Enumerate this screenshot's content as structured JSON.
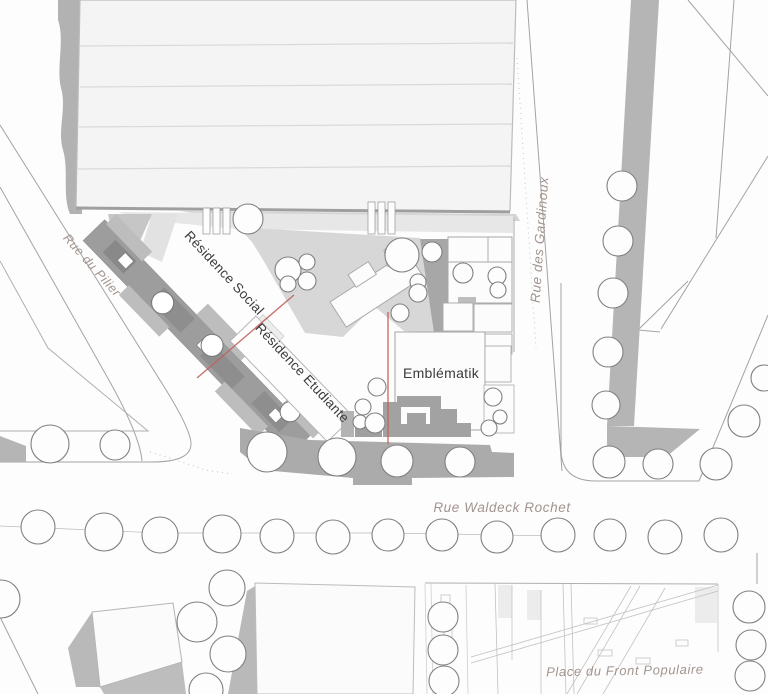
{
  "plan": {
    "streets": {
      "rue_du_pilier": "Rue du Pilier",
      "rue_des_gardinoux": "Rue des Gardinoux",
      "rue_waldeck_rochet": "Rue Waldeck Rochet",
      "place_du_front_populaire": "Place du Front Populaire"
    },
    "buildings": {
      "residence_social": "Résidence Social",
      "residence_etudiante": "Résidence Etudiante",
      "emblematik": "Emblématik"
    }
  },
  "colors": {
    "street_label": "#a2948e",
    "building_label": "#3b3b3b",
    "site_boundary_line": "#c0635c",
    "tree_outline": "#808080",
    "courtyard_gray": "#d7d7d7",
    "shadow_gray": "#a7a7a7",
    "band_gray": "#b5b5b5"
  }
}
